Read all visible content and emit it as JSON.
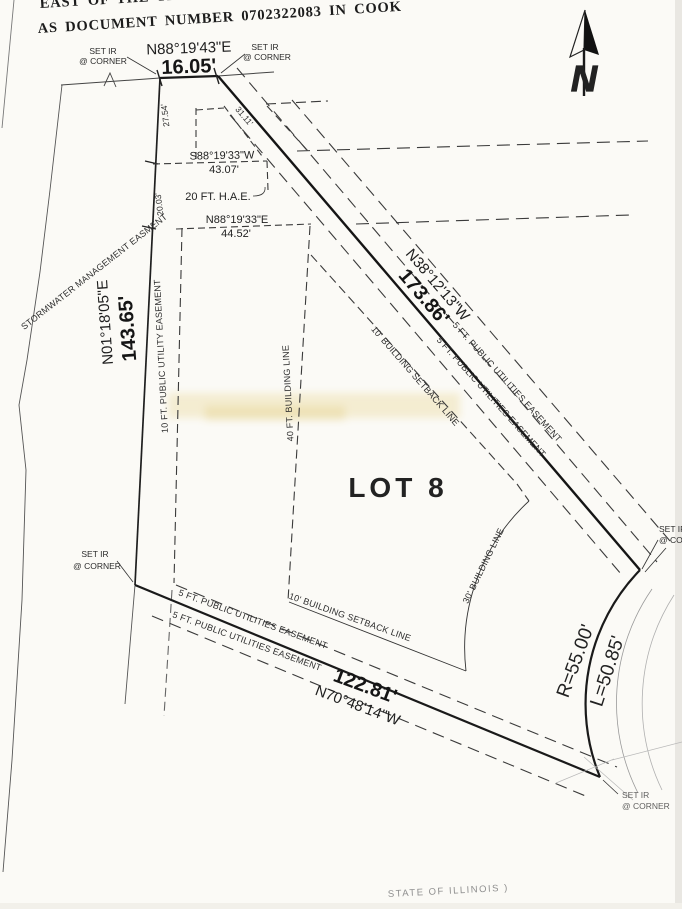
{
  "page": {
    "header_line1": "EAST OF THE THIRD P",
    "header_line2": "AS DOCUMENT NUMBER 0702322083 IN COOK",
    "footer_line": "STATE OF ILLINOIS  )"
  },
  "compass": {
    "letter": "N"
  },
  "lot": {
    "label": "LOT 8"
  },
  "north_line": {
    "bearing": "N88°19'43\"E",
    "distance": "16.05'"
  },
  "west_line": {
    "bearing": "N01°18'05\"E",
    "distance": "143.65'",
    "seg1": "27.54'",
    "seg2": "20.03'"
  },
  "northeast_line": {
    "bearing": "N38°12'13\"W",
    "distance": "173.86'"
  },
  "south_line": {
    "bearing": "N70°48'14\"W",
    "distance": "122.81'"
  },
  "curve": {
    "radius": "R=55.00'",
    "arc": "L=50.85'"
  },
  "hae": {
    "label": "20 FT. H.A.E.",
    "tie": "31.11'",
    "north": {
      "bearing": "S88°19'33\"W",
      "distance": "43.07'"
    },
    "south": {
      "bearing": "N88°19'33\"E",
      "distance": "44.52'"
    }
  },
  "easements": {
    "stormwater": "STORMWATER MANAGEMENT EASMENT",
    "public_utility_10ft": "10 FT. PUBLIC UTILITY EASEMENT",
    "public_utilities_5ft": "5 FT. PUBLIC UTILITIES EASEMENT"
  },
  "building_lines": {
    "line_40ft": "40 FT. BUILDING LINE",
    "setback_10ft": "10' BUILDING SETBACK LINE",
    "line_30ft": "30' BUILDING LINE"
  },
  "markers": {
    "set_ir": "SET IR",
    "at_corner": "@ CORNER"
  }
}
